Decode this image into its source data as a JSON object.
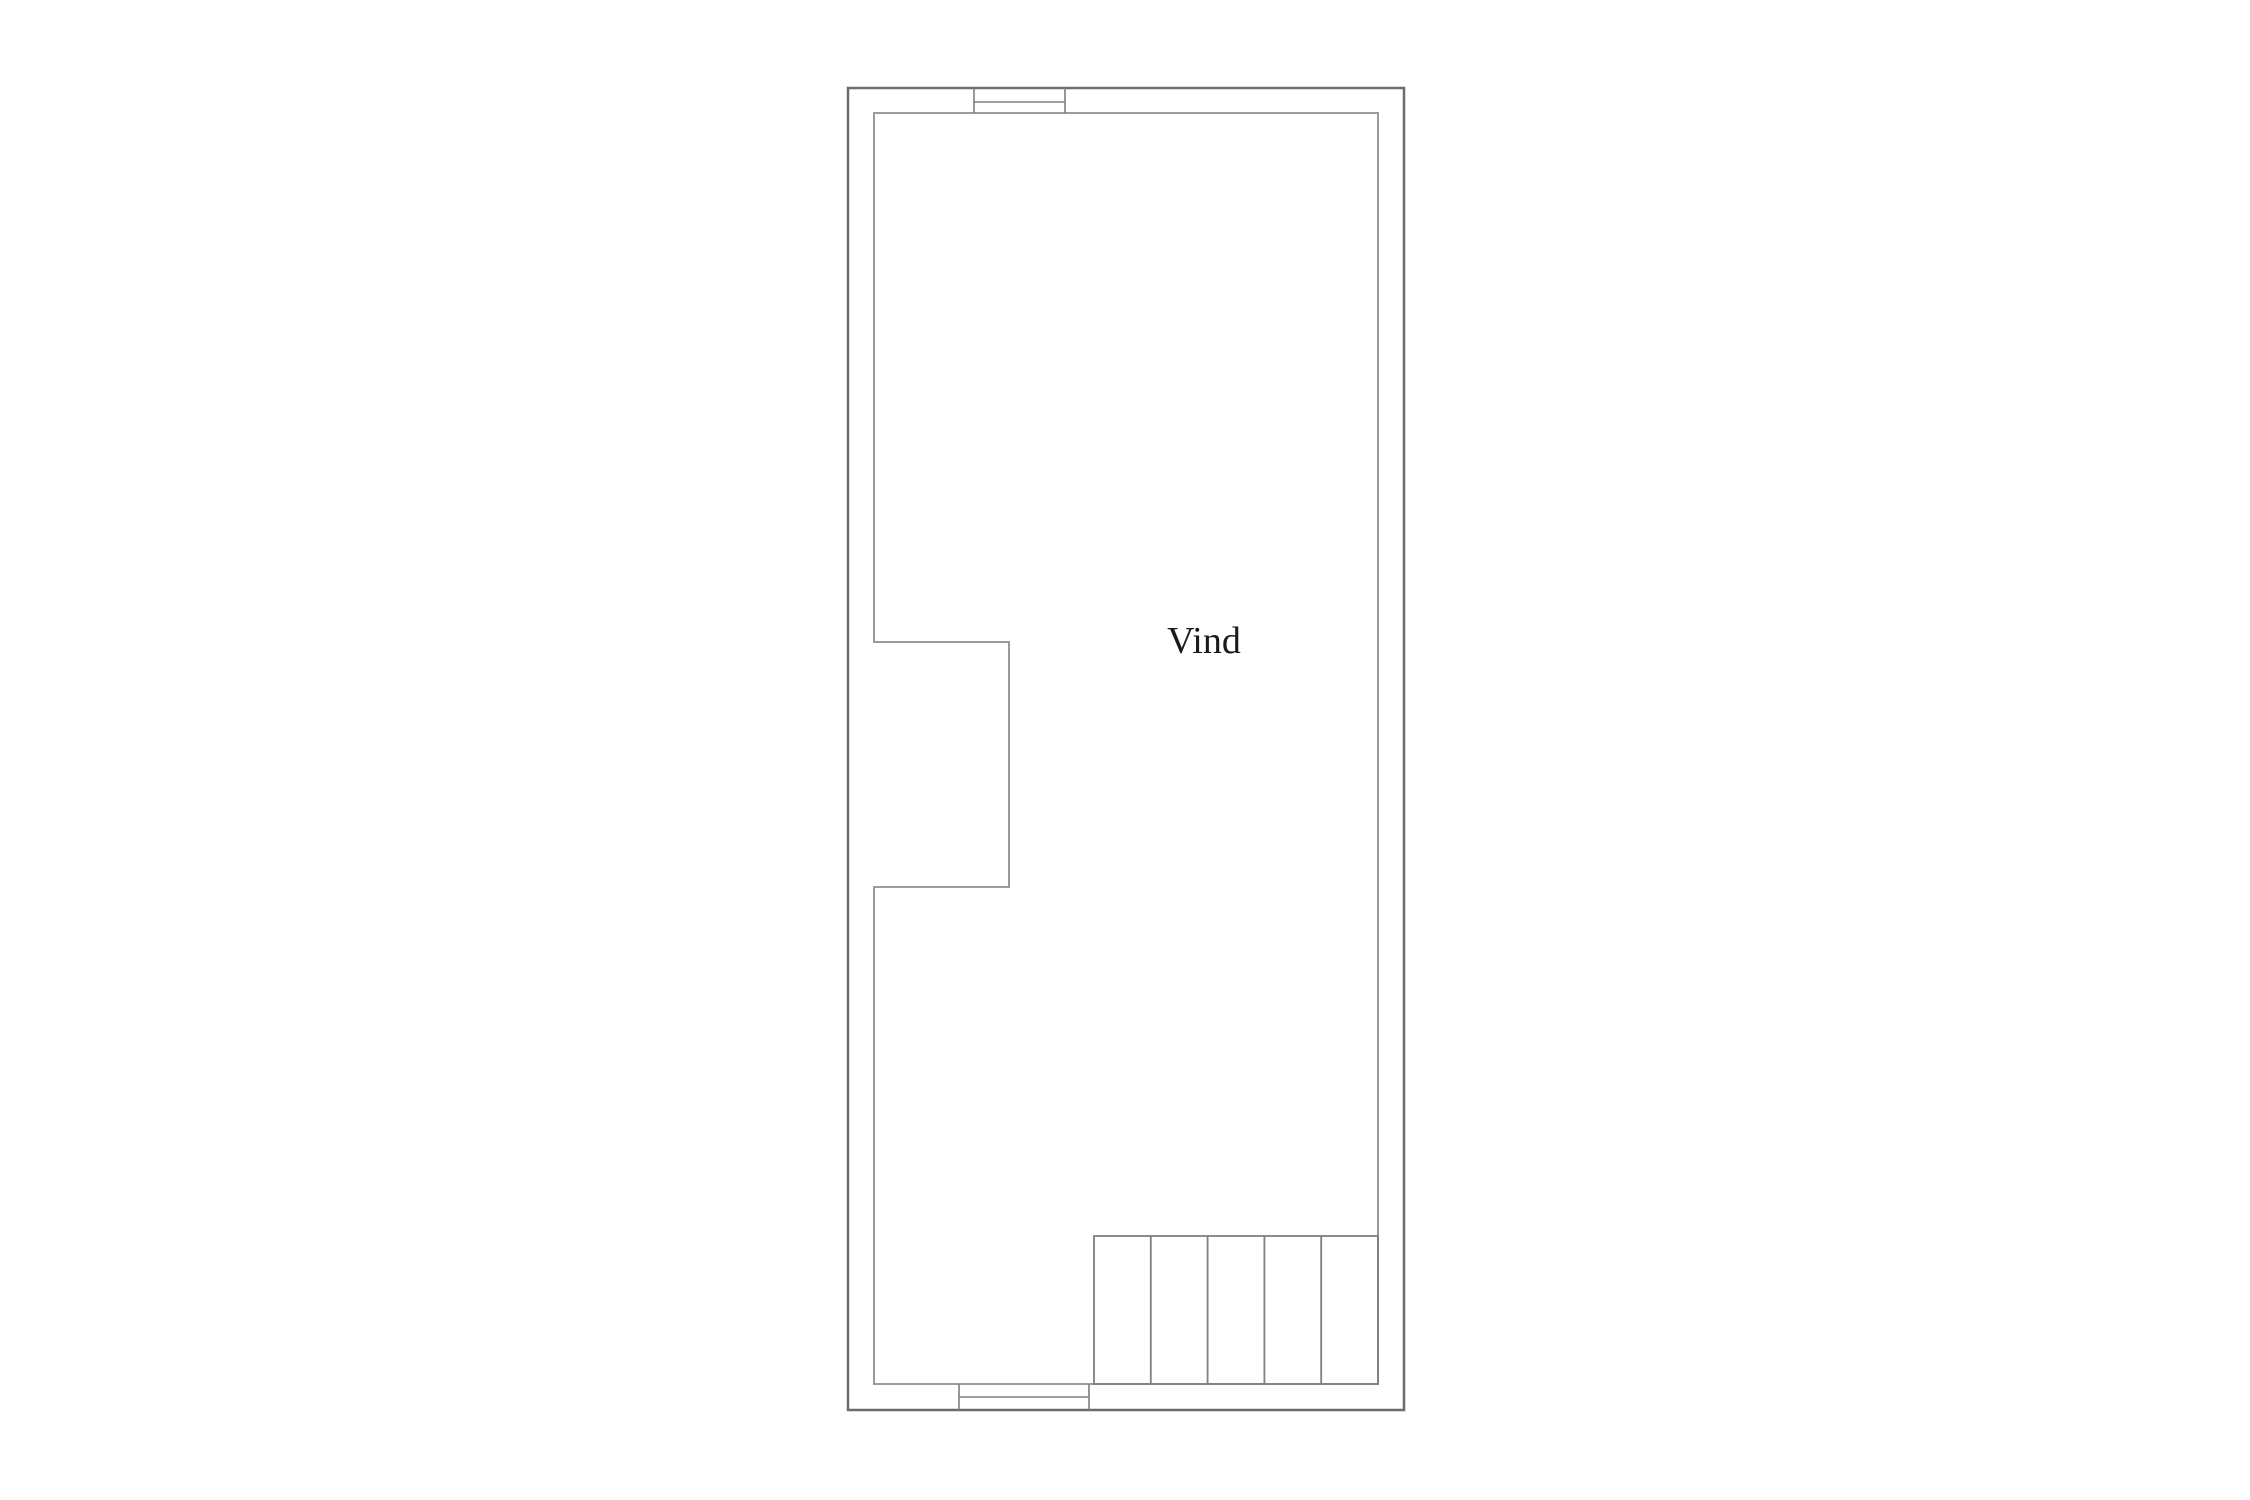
{
  "plan": {
    "room_label": "Vind"
  },
  "colors": {
    "background": "#ffffff",
    "outer_wall": "#6d6d6d",
    "inner_wall": "#8f8f8f",
    "window_lines": "#7f7f7f",
    "stair_lines": "#7f7f7f",
    "label_text": "#1a1a1a"
  },
  "stairs": {
    "tread_count": 5
  },
  "windows": {
    "count": 2
  }
}
